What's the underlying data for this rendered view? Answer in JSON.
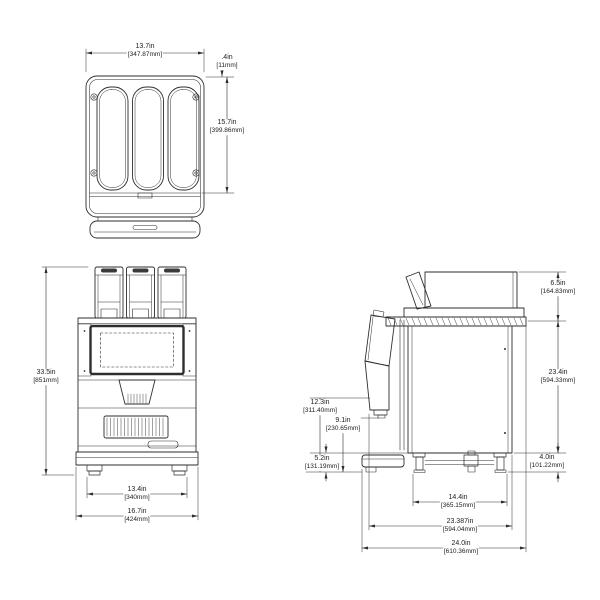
{
  "drawing_colors": {
    "line": "#2e2e2e",
    "background": "#ffffff",
    "lid_fill": "#3a3a3a"
  },
  "views": {
    "top": {
      "width": {
        "inches": "13.7in",
        "mm": "[347.87mm]"
      },
      "lip": {
        "inches": ".4in",
        "mm": "[11mm]"
      },
      "depth": {
        "inches": "15.7in",
        "mm": "[399.86mm]"
      }
    },
    "front": {
      "height": {
        "inches": "33.5in",
        "mm": "[851mm]"
      },
      "feet_span": {
        "inches": "13.4in",
        "mm": "[340mm]"
      },
      "width": {
        "inches": "16.7in",
        "mm": "[424mm]"
      }
    },
    "side": {
      "hopper_height": {
        "inches": "6.5in",
        "mm": "[164.83mm]"
      },
      "body_height": {
        "inches": "23.4in",
        "mm": "[594.33mm]"
      },
      "leg_height": {
        "inches": "4.0in",
        "mm": "[101.22mm]"
      },
      "dispense_height": {
        "inches": "12.3in",
        "mm": "[311.40mm]"
      },
      "cup_clearance": {
        "inches": "9.1in",
        "mm": "[230.65mm]"
      },
      "base_height": {
        "inches": "5.2in",
        "mm": "[131.19mm]"
      },
      "leg_span": {
        "inches": "14.4in",
        "mm": "[365.15mm]"
      },
      "body_depth": {
        "inches": "23.387in",
        "mm": "[594.04mm]"
      },
      "overall_depth": {
        "inches": "24.0in",
        "mm": "[610.36mm]"
      }
    }
  }
}
